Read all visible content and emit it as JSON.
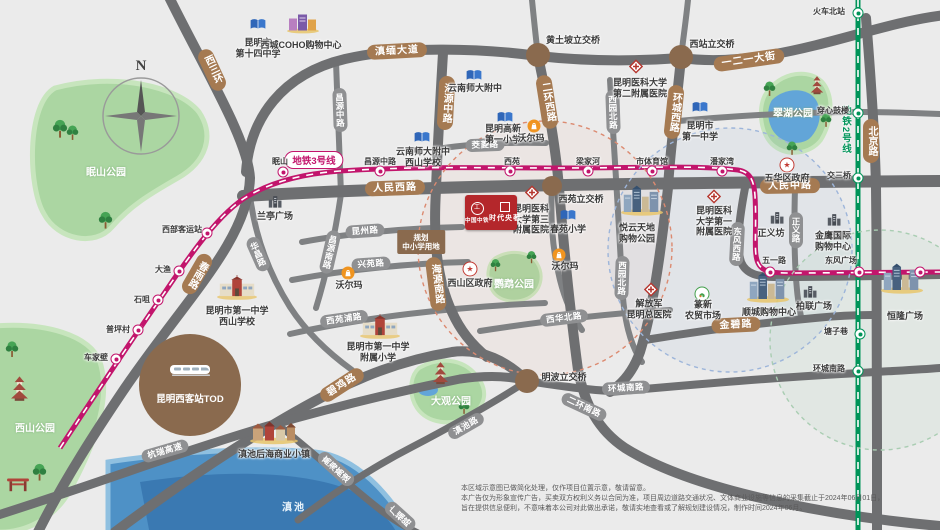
{
  "colors": {
    "bg": "#ebebeb",
    "road": "#6e6f71",
    "road_minor": "#7f8183",
    "pill_major": "#a57a52",
    "pill_minor": "#8f9092",
    "metro3": "#c2156c",
    "metro2": "#009459",
    "park": "#abd6a2",
    "water": "#4e91c6",
    "project_red": "#b4272b"
  },
  "compass": {
    "label": "N"
  },
  "project": {
    "brand": "中国中铁",
    "name": "时代央著"
  },
  "tod": {
    "name": "昆明西客站TOD"
  },
  "planning_plot": {
    "lines": [
      "规划",
      "中小学用地"
    ]
  },
  "metro": {
    "line3": {
      "label": "地铁3号线",
      "bubble": {
        "x": 314,
        "y": 160
      },
      "stations": [
        {
          "name": "车家壁",
          "x": 116,
          "y": 359,
          "lx": 96,
          "ly": 358
        },
        {
          "name": "普坪村",
          "x": 138,
          "y": 330,
          "lx": 118,
          "ly": 330
        },
        {
          "name": "石咀",
          "x": 158,
          "y": 300,
          "lx": 142,
          "ly": 300
        },
        {
          "name": "大渔",
          "x": 179,
          "y": 271,
          "lx": 163,
          "ly": 270
        },
        {
          "name": "西部客运站",
          "x": 207,
          "y": 233,
          "lx": 182,
          "ly": 230
        },
        {
          "name": "眠山",
          "x": 283,
          "y": 172,
          "lx": 280,
          "ly": 162
        },
        {
          "name": "昌源中路",
          "x": 380,
          "y": 171,
          "lx": 380,
          "ly": 162
        },
        {
          "name": "西苑",
          "x": 510,
          "y": 171,
          "lx": 512,
          "ly": 162
        },
        {
          "name": "梁家河",
          "x": 588,
          "y": 171,
          "lx": 588,
          "ly": 162
        },
        {
          "name": "市体育馆",
          "x": 652,
          "y": 171,
          "lx": 652,
          "ly": 162
        },
        {
          "name": "潘家湾",
          "x": 722,
          "y": 171,
          "lx": 722,
          "ly": 162
        },
        {
          "name": "五一路",
          "x": 770,
          "y": 272,
          "lx": 774,
          "ly": 261
        },
        {
          "name": "东风广场",
          "x": 859,
          "y": 272,
          "lx": 841,
          "ly": 261
        },
        {
          "name": "",
          "x": 920,
          "y": 272,
          "lx": 920,
          "ly": 262
        }
      ]
    },
    "line2": {
      "label": "地铁2号线",
      "label_pos": {
        "x": 845,
        "y": 130
      },
      "stations": [
        {
          "name": "火车北站",
          "x": 858,
          "y": 13,
          "lx": 829,
          "ly": 12
        },
        {
          "name": "穿心鼓楼",
          "x": 858,
          "y": 113,
          "lx": 833,
          "ly": 111
        },
        {
          "name": "交三桥",
          "x": 858,
          "y": 178,
          "lx": 839,
          "ly": 176
        },
        {
          "name": "塘子巷",
          "x": 860,
          "y": 334,
          "lx": 836,
          "ly": 332
        },
        {
          "name": "环城南路",
          "x": 858,
          "y": 371,
          "lx": 829,
          "ly": 369
        }
      ]
    }
  },
  "road_pills": [
    {
      "text": "西三环",
      "major": true,
      "vert": true,
      "x": 212,
      "y": 70,
      "rot": -25
    },
    {
      "text": "滇缅大道",
      "major": true,
      "x": 397,
      "y": 51,
      "rot": -3
    },
    {
      "text": "一二一大街",
      "major": true,
      "x": 749,
      "y": 60,
      "rot": -8
    },
    {
      "text": "海源中路",
      "major": true,
      "vert": true,
      "x": 446,
      "y": 103,
      "rot": 3
    },
    {
      "text": "二环西路",
      "major": true,
      "vert": true,
      "x": 547,
      "y": 102,
      "rot": -9
    },
    {
      "text": "环城西路",
      "major": true,
      "vert": true,
      "x": 674,
      "y": 112,
      "rot": 6
    },
    {
      "text": "北京路",
      "major": true,
      "vert": true,
      "x": 871,
      "y": 141,
      "rot": 0
    },
    {
      "text": "人民西路",
      "major": true,
      "x": 395,
      "y": 188,
      "rot": -2
    },
    {
      "text": "人民中路",
      "major": true,
      "x": 790,
      "y": 186,
      "rot": -1
    },
    {
      "text": "春雨路",
      "major": true,
      "vert": true,
      "x": 197,
      "y": 274,
      "rot": 30
    },
    {
      "text": "海源南路",
      "major": true,
      "vert": true,
      "x": 436,
      "y": 284,
      "rot": -7
    },
    {
      "text": "碧鸡路",
      "major": true,
      "x": 342,
      "y": 385,
      "rot": -33
    },
    {
      "text": "金碧路",
      "major": true,
      "x": 736,
      "y": 325,
      "rot": -3
    },
    {
      "text": "昌源中路",
      "vert": true,
      "x": 340,
      "y": 110,
      "rot": -2
    },
    {
      "text": "昌源南路",
      "vert": true,
      "x": 330,
      "y": 252,
      "rot": 13
    },
    {
      "text": "昆州路",
      "x": 365,
      "y": 231,
      "rot": -4
    },
    {
      "text": "兴苑路",
      "x": 371,
      "y": 264,
      "rot": -4
    },
    {
      "text": "茭菱路",
      "x": 485,
      "y": 145,
      "rot": -2
    },
    {
      "text": "西苑浦路",
      "x": 344,
      "y": 319,
      "rot": -8
    },
    {
      "text": "西华北路",
      "x": 564,
      "y": 318,
      "rot": -7
    },
    {
      "text": "西园北路",
      "vert": true,
      "x": 613,
      "y": 112,
      "rot": -2
    },
    {
      "text": "西园北路",
      "vert": true,
      "x": 622,
      "y": 278,
      "rot": 2
    },
    {
      "text": "华昌路",
      "vert": true,
      "x": 258,
      "y": 254,
      "rot": -24
    },
    {
      "text": "东风西路",
      "vert": true,
      "x": 737,
      "y": 244,
      "rot": 3
    },
    {
      "text": "正义路",
      "vert": true,
      "x": 796,
      "y": 230,
      "rot": 0
    },
    {
      "text": "环城南路",
      "x": 626,
      "y": 388,
      "rot": -3
    },
    {
      "text": "二环南路",
      "x": 584,
      "y": 407,
      "rot": 25
    },
    {
      "text": "滇池路",
      "x": 466,
      "y": 426,
      "rot": -30
    },
    {
      "text": "杭瑞高速",
      "x": 165,
      "y": 451,
      "rot": -16
    },
    {
      "text": "高海高速",
      "vert": true,
      "x": 336,
      "y": 469,
      "rot": -48
    },
    {
      "text": "广福路",
      "vert": true,
      "x": 400,
      "y": 516,
      "rot": -48
    }
  ],
  "junctions": [
    {
      "name": "黄土坡立交桥",
      "x": 538,
      "y": 55,
      "lx": 573,
      "ly": 40
    },
    {
      "name": "西站立交桥",
      "x": 681,
      "y": 57,
      "lx": 712,
      "ly": 44
    },
    {
      "name": "西苑立交桥",
      "x": 552,
      "y": 186,
      "lx": 581,
      "ly": 199,
      "small": true
    },
    {
      "name": "明波立交桥",
      "x": 527,
      "y": 381,
      "lx": 564,
      "ly": 377
    }
  ],
  "pois": [
    {
      "icon": "school",
      "x": 258,
      "y": 26,
      "lines": [
        "昆明市",
        "第十四中学"
      ],
      "lx": 258,
      "ly": 48
    },
    {
      "icon": "mall",
      "x": 303,
      "y": 25,
      "lines": [
        "西城COHO购物中心"
      ],
      "lx": 301,
      "ly": 45
    },
    {
      "icon": "school",
      "x": 474,
      "y": 77,
      "lines": [
        "云南师大附中"
      ],
      "lx": 475,
      "ly": 88
    },
    {
      "icon": "school",
      "x": 505,
      "y": 119,
      "lines": [
        "昆明高新",
        "第一小学"
      ],
      "lx": 503,
      "ly": 134
    },
    {
      "icon": "school",
      "x": 422,
      "y": 139,
      "lines": [
        "云南师大附中",
        "西山学校"
      ],
      "lx": 423,
      "ly": 157
    },
    {
      "icon": "school",
      "x": 700,
      "y": 109,
      "lines": [
        "昆明市",
        "第一中学"
      ],
      "lx": 700,
      "ly": 131
    },
    {
      "icon": "school",
      "x": 568,
      "y": 217,
      "lines": [
        "春苑小学"
      ],
      "lx": 568,
      "ly": 229
    },
    {
      "icon": "hospital",
      "x": 636,
      "y": 69,
      "lines": [
        "昆明医科大学",
        "第二附属医院"
      ],
      "lx": 640,
      "ly": 88
    },
    {
      "icon": "hospital",
      "x": 532,
      "y": 195,
      "lines": [
        "昆明医科",
        "大学第三",
        "附属医院"
      ],
      "lx": 531,
      "ly": 219
    },
    {
      "icon": "hospital",
      "x": 714,
      "y": 199,
      "lines": [
        "昆明医科",
        "大学第一",
        "附属医院"
      ],
      "lx": 714,
      "ly": 221
    },
    {
      "icon": "hospital",
      "x": 651,
      "y": 292,
      "lines": [
        "解放军",
        "昆明总医院"
      ],
      "lx": 649,
      "ly": 309
    },
    {
      "icon": "walmart",
      "x": 534,
      "y": 126,
      "lines": [
        "沃尔玛"
      ],
      "lx": 531,
      "ly": 138
    },
    {
      "icon": "walmart",
      "x": 559,
      "y": 255,
      "lines": [
        "沃尔玛"
      ],
      "lx": 565,
      "ly": 266
    },
    {
      "icon": "walmart",
      "x": 348,
      "y": 273,
      "lines": [
        "沃尔玛"
      ],
      "lx": 349,
      "ly": 285
    },
    {
      "icon": "building",
      "x": 275,
      "y": 204,
      "lines": [
        "兰亭广场"
      ],
      "lx": 275,
      "ly": 216
    },
    {
      "icon": "complex",
      "x": 642,
      "y": 203,
      "lines": [
        "悦云天地",
        "购物公园"
      ],
      "lx": 637,
      "ly": 233
    },
    {
      "icon": "building",
      "x": 834,
      "y": 222,
      "lines": [
        "金鹰国际",
        "购物中心"
      ],
      "lx": 833,
      "ly": 241
    },
    {
      "icon": "building",
      "x": 777,
      "y": 220,
      "lines": [
        "正义坊"
      ],
      "lx": 771,
      "ly": 233
    },
    {
      "icon": "complex",
      "x": 768,
      "y": 290,
      "lines": [
        "顺城购物中心"
      ],
      "lx": 769,
      "ly": 312
    },
    {
      "icon": "building",
      "x": 810,
      "y": 294,
      "lines": [
        "柏联广场"
      ],
      "lx": 814,
      "ly": 306
    },
    {
      "icon": "complex",
      "x": 902,
      "y": 281,
      "lines": [
        "恒隆广场"
      ],
      "lx": 905,
      "ly": 316
    },
    {
      "icon": "market",
      "x": 702,
      "y": 294,
      "lines": [
        "篆新",
        "农贸市场"
      ],
      "lx": 703,
      "ly": 310
    },
    {
      "icon": "town",
      "x": 274,
      "y": 434,
      "lines": [
        "滇池后海商业小镇"
      ],
      "lx": 274,
      "ly": 454
    },
    {
      "icon": "school-big",
      "x": 237,
      "y": 290,
      "lines": [
        "昆明市第一中学",
        "西山学校"
      ],
      "lx": 237,
      "ly": 316
    },
    {
      "icon": "school-big",
      "x": 380,
      "y": 329,
      "lines": [
        "昆明市第一中学",
        "附属小学"
      ],
      "lx": 378,
      "ly": 352
    },
    {
      "icon": "gov",
      "x": 787,
      "y": 165,
      "lines": [
        "五华区政府"
      ],
      "lx": 787,
      "ly": 178
    },
    {
      "icon": "gov",
      "x": 470,
      "y": 269,
      "lines": [
        "西山区政府"
      ],
      "lx": 470,
      "ly": 283
    }
  ],
  "park_labels": [
    {
      "name": "眠山公园",
      "x": 106,
      "y": 171
    },
    {
      "name": "西山公园",
      "x": 35,
      "y": 427
    },
    {
      "name": "翠湖公园",
      "x": 793,
      "y": 112
    },
    {
      "name": "大观公园",
      "x": 451,
      "y": 400
    },
    {
      "name": "鹦鹉公园",
      "x": 514,
      "y": 283
    }
  ],
  "water_labels": [
    {
      "name": "滇池",
      "x": 294,
      "y": 506
    }
  ],
  "disclaimer": {
    "lines": [
      "本区域示意图已做简化处理，仅作项目位置示意，敬请留意。",
      "本广告仅为形象宣传广告，买卖双方权利义务以合同为准，项目周边道路交通状况、文体商业设施等信息的采集截止于2024年06月01日，",
      "旨在提供信息便利，不意味着本公司对此做出承诺，敬请实地查看或了解规划建设情况，制作时间2024年06月。"
    ]
  }
}
